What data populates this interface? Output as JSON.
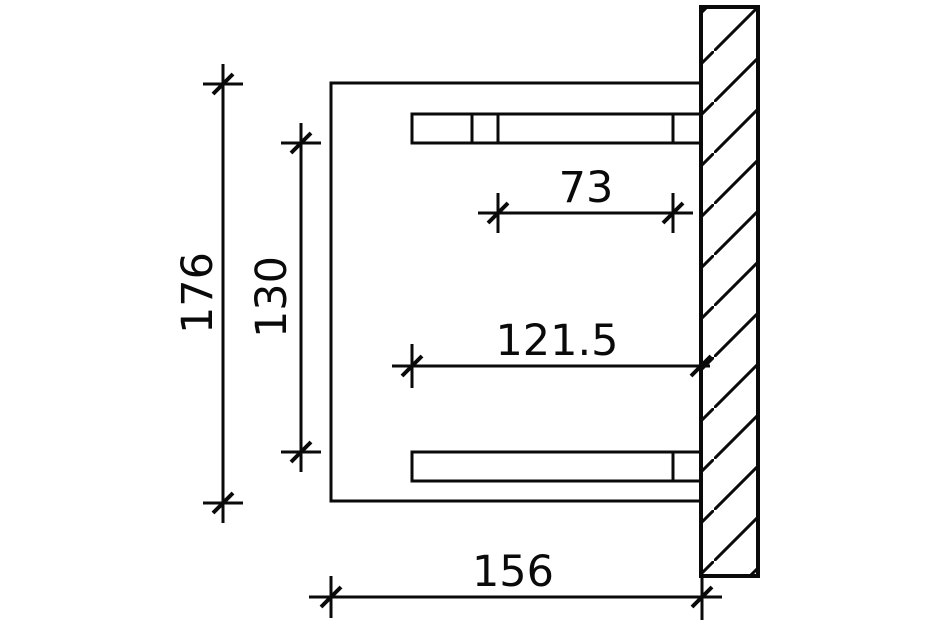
{
  "drawing": {
    "kind": "technical-dimension-drawing",
    "colors": {
      "ink": "#0a0a0a",
      "background": "#ffffff"
    },
    "dimensions": {
      "overall_height": {
        "value": "176"
      },
      "beam_spacing": {
        "value": "130"
      },
      "top_beam_segment": {
        "value": "73"
      },
      "beam_length": {
        "value": "121.5"
      },
      "overall_depth": {
        "value": "156"
      }
    }
  }
}
